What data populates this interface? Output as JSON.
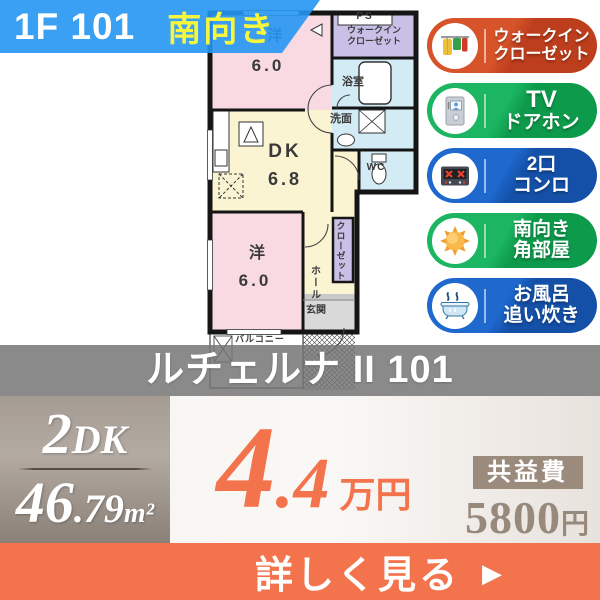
{
  "header": {
    "unit_label": "1F 101",
    "facing_label": "南向き"
  },
  "floorplan": {
    "room_west_top": {
      "name": "洋",
      "size": "6.0"
    },
    "room_dk": {
      "name": "DK",
      "size": "6.8"
    },
    "room_west_bottom": {
      "name": "洋",
      "size": "6.0"
    },
    "ps_label": "PS",
    "wic_line1": "ウォークイン",
    "wic_line2": "クローゼット",
    "bath_label": "浴室",
    "wash_label": "洗面",
    "wc_label": "WC",
    "hall_label": "ホール",
    "closet_label": "クローゼット",
    "entrance_label": "玄関",
    "balcony_label": "バルコニー"
  },
  "features": [
    {
      "icon": "walk-in-closet",
      "line1": "ウォークイン",
      "line2": "クローゼット",
      "color": "#c84620"
    },
    {
      "icon": "tv-doorphone",
      "line1": "TV",
      "line2": "ドアホン",
      "color": "#12a555"
    },
    {
      "icon": "two-burner-stove",
      "line1": "2口",
      "line2": "コンロ",
      "color": "#195cba"
    },
    {
      "icon": "south-facing-sun",
      "line1": "南向き",
      "line2": "角部屋",
      "color": "#12a555"
    },
    {
      "icon": "bath-reheating",
      "line1": "お風呂",
      "line2": "追い炊き",
      "color": "#195cba"
    }
  ],
  "property": {
    "name": "ルチェルナ II 101",
    "layout_num": "2",
    "layout_type": "DK",
    "area_int": "46",
    "area_frac": ".79",
    "area_unit": "m²",
    "rent_int": "4",
    "rent_frac": ".4",
    "rent_unit": "万円",
    "fee_label": "共益費",
    "fee_amount": "5800",
    "fee_unit": "円"
  },
  "cta": {
    "label": "詳しく見る",
    "arrow": "▶"
  },
  "colors": {
    "header_blue": "#2596f3",
    "accent_yellow": "#f6f63e",
    "price_orange": "#f3744c",
    "cta_orange": "#f2734c",
    "badge_orange": "#c84620",
    "badge_green": "#12a555",
    "badge_blue": "#195cba",
    "name_band_gray": "#8d8d8d",
    "spec_box_taupe": "#9e948c",
    "fee_taupe": "#97897b"
  }
}
